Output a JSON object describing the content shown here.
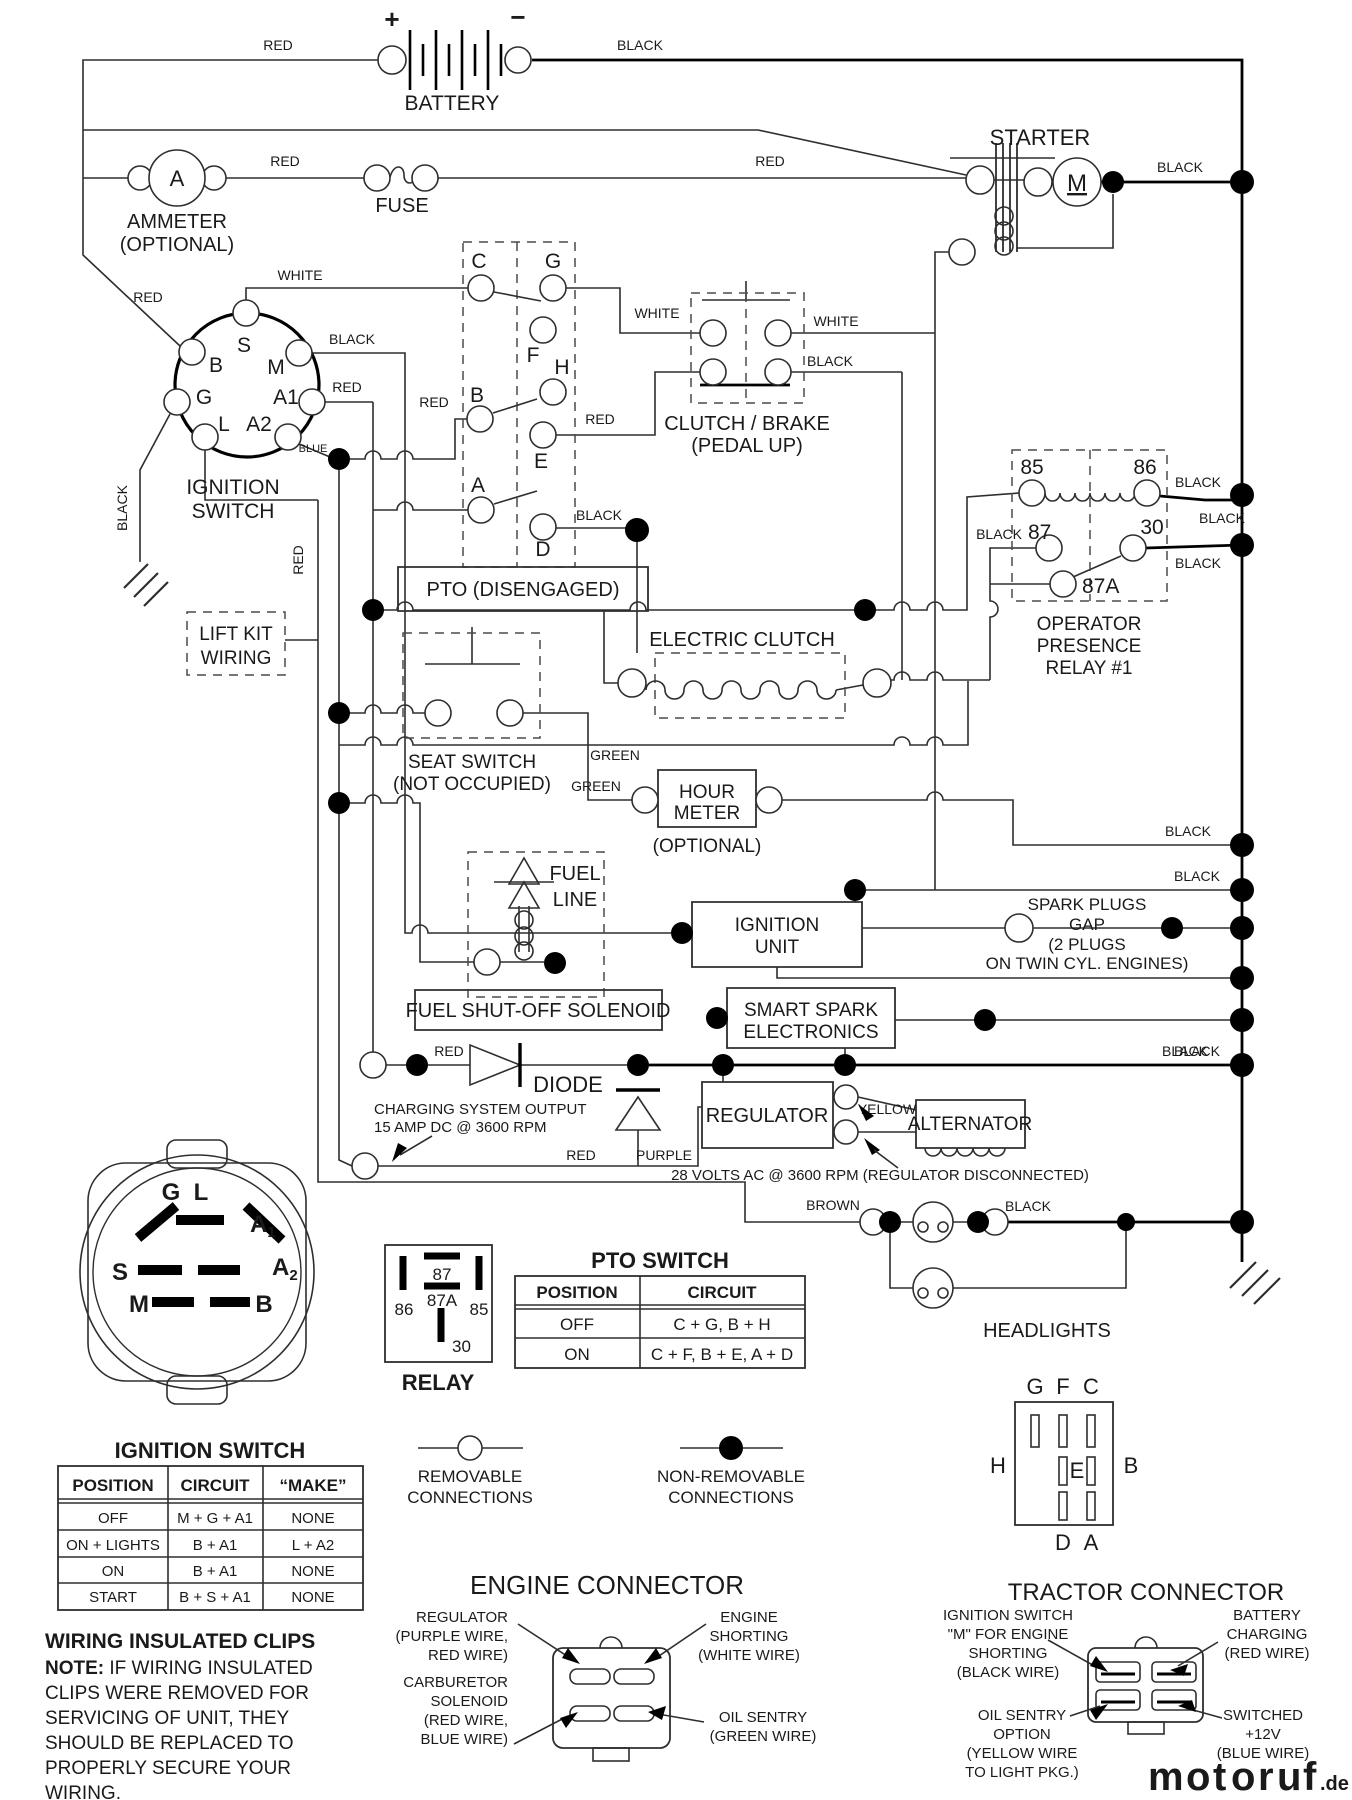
{
  "top": {
    "battery": {
      "label": "BATTERY",
      "plus": "+",
      "minus": "−",
      "wire_red": "RED",
      "wire_black": "BLACK"
    },
    "ammeter": {
      "symbol": "A",
      "line1": "AMMETER",
      "line2": "(OPTIONAL)",
      "wire_red": "RED"
    },
    "fuse": {
      "label": "FUSE",
      "wire_red": "RED"
    },
    "starter": {
      "label": "STARTER",
      "motor": "M",
      "wire_black": "BLACK"
    }
  },
  "ignition_switch": {
    "line1": "IGNITION",
    "line2": "SWITCH",
    "t_s": "S",
    "t_m": "M",
    "t_b": "B",
    "t_g": "G",
    "t_a1": "A1",
    "t_l": "L",
    "t_a2": "A2",
    "wire_red_b": "RED",
    "wire_black_m": "BLACK",
    "wire_red_a1": "RED",
    "wire_blue": "BLUE",
    "wire_black_gnd": "BLACK",
    "wire_red_down": "RED"
  },
  "lift_kit": {
    "line1": "LIFT KIT",
    "line2": "WIRING"
  },
  "pto_disengaged": {
    "label": "PTO (DISENGAGED)",
    "t_c": "C",
    "t_g": "G",
    "t_f": "F",
    "t_h": "H",
    "t_b": "B",
    "t_e": "E",
    "t_a": "A",
    "t_d": "D",
    "wire_white_c": "WHITE",
    "wire_white_g": "WHITE",
    "wire_red_b": "RED",
    "wire_red_e": "RED",
    "wire_black_d": "BLACK"
  },
  "clutch_brake": {
    "line1": "CLUTCH / BRAKE",
    "line2": "(PEDAL UP)",
    "wire_white": "WHITE",
    "wire_black": "BLACK"
  },
  "op_relay": {
    "t85": "85",
    "t86": "86",
    "t87": "87",
    "t30": "30",
    "t87a": "87A",
    "line1": "OPERATOR",
    "line2": "PRESENCE",
    "line3": "RELAY #1",
    "wire_black_86": "BLACK",
    "wire_black_mid": "BLACK",
    "wire_black_30": "BLACK",
    "wire_black_87": "BLACK"
  },
  "electric_clutch": {
    "label": "ELECTRIC CLUTCH",
    "wire_green": "GREEN"
  },
  "seat_switch": {
    "line1": "SEAT SWITCH",
    "line2": "(NOT OCCUPIED)",
    "wire_green": "GREEN"
  },
  "hour_meter": {
    "line1": "HOUR",
    "line2": "METER",
    "line3": "(OPTIONAL)",
    "wire_black": "BLACK"
  },
  "fuel": {
    "line1": "FUEL",
    "line2": "LINE",
    "solenoid": "FUEL SHUT-OFF SOLENOID"
  },
  "ignition_unit": {
    "line1": "IGNITION",
    "line2": "UNIT",
    "wire_black": "BLACK"
  },
  "spark_plugs": {
    "line1": "SPARK PLUGS",
    "line2": "GAP",
    "line3": "(2 PLUGS",
    "line4": "ON TWIN CYL. ENGINES)",
    "wire_black": "BLACK"
  },
  "smart_spark": {
    "line1": "SMART SPARK",
    "line2": "ELECTRONICS"
  },
  "diode": {
    "label": "DIODE",
    "wire_red": "RED",
    "charging1": "CHARGING SYSTEM OUTPUT",
    "charging2": "15 AMP DC @ 3600 RPM",
    "wire_red2": "RED",
    "wire_purple": "PURPLE",
    "wire_black": "BLACK"
  },
  "regulator": {
    "label": "REGULATOR",
    "wire_yellow": "YELLOW",
    "note": "28 VOLTS AC @ 3600 RPM (REGULATOR DISCONNECTED)"
  },
  "alternator": {
    "label": "ALTERNATOR"
  },
  "headlights": {
    "label": "HEADLIGHTS",
    "wire_brown": "BROWN",
    "wire_black": "BLACK"
  },
  "ign_face": {
    "g": "G",
    "l": "L",
    "a1": "A",
    "a1_sub": "1",
    "a2": "A",
    "a2_sub": "2",
    "s": "S",
    "m": "M",
    "b": "B"
  },
  "relay_legend": {
    "t87": "87",
    "t87a": "87A",
    "t86": "86",
    "t85": "85",
    "t30": "30",
    "label": "RELAY"
  },
  "pto_table": {
    "title": "PTO SWITCH",
    "h1": "POSITION",
    "h2": "CIRCUIT",
    "rows": [
      {
        "position": "OFF",
        "circuit": "C + G, B + H"
      },
      {
        "position": "ON",
        "circuit": "C + F, B + E, A + D"
      }
    ]
  },
  "ignition_table": {
    "title": "IGNITION SWITCH",
    "h1": "POSITION",
    "h2": "CIRCUIT",
    "h3": "“MAKE”",
    "rows": [
      {
        "position": "OFF",
        "circuit": "M + G + A1",
        "make": "NONE"
      },
      {
        "position": "ON + LIGHTS",
        "circuit": "B + A1",
        "make": "L + A2"
      },
      {
        "position": "ON",
        "circuit": "B + A1",
        "make": "NONE"
      },
      {
        "position": "START",
        "circuit": "B + S + A1",
        "make": "NONE"
      }
    ]
  },
  "legend": {
    "removable1": "REMOVABLE",
    "removable2": "CONNECTIONS",
    "nonremovable1": "NON-REMOVABLE",
    "nonremovable2": "CONNECTIONS"
  },
  "pto_face": {
    "g": "G",
    "f": "F",
    "c": "C",
    "h": "H",
    "e": "E",
    "b": "B",
    "d": "D",
    "a": "A"
  },
  "engine_connector": {
    "title": "ENGINE CONNECTOR",
    "reg1": "REGULATOR",
    "reg2": "(PURPLE WIRE,",
    "reg3": "RED WIRE)",
    "eng1": "ENGINE",
    "eng2": "SHORTING",
    "eng3": "(WHITE WIRE)",
    "carb1": "CARBURETOR",
    "carb2": "SOLENOID",
    "carb3": "(RED WIRE,",
    "carb4": "BLUE WIRE)",
    "oil1": "OIL SENTRY",
    "oil2": "(GREEN WIRE)"
  },
  "tractor_connector": {
    "title": "TRACTOR CONNECTOR",
    "ign1": "IGNITION SWITCH",
    "ign2": "\"M\" FOR ENGINE",
    "ign3": "SHORTING",
    "ign4": "(BLACK WIRE)",
    "bat1": "BATTERY",
    "bat2": "CHARGING",
    "bat3": "(RED WIRE)",
    "oil1": "OIL SENTRY",
    "oil2": "OPTION",
    "oil3": "(YELLOW WIRE",
    "oil4": "TO LIGHT PKG.)",
    "sw1": "SWITCHED",
    "sw2": "+12V",
    "sw3": "(BLUE WIRE)"
  },
  "clips": {
    "title": "WIRING INSULATED CLIPS",
    "note_prefix": "NOTE:",
    "line1": " IF WIRING INSULATED",
    "line2": "CLIPS WERE REMOVED FOR",
    "line3": "SERVICING OF UNIT, THEY",
    "line4": "SHOULD BE REPLACED TO",
    "line5": "PROPERLY SECURE YOUR",
    "line6": "WIRING."
  },
  "watermark": {
    "letters": [
      "m",
      "o",
      "t",
      "o",
      "r",
      "u",
      "f"
    ],
    "colors": [
      "#4a63c8",
      "#8f4fc0",
      "#3fa04a",
      "#e8519c",
      "#3fa04a",
      "#e03a34",
      "#f0a12f"
    ],
    "suffix": ".de",
    "suffix_color": "#666666"
  }
}
